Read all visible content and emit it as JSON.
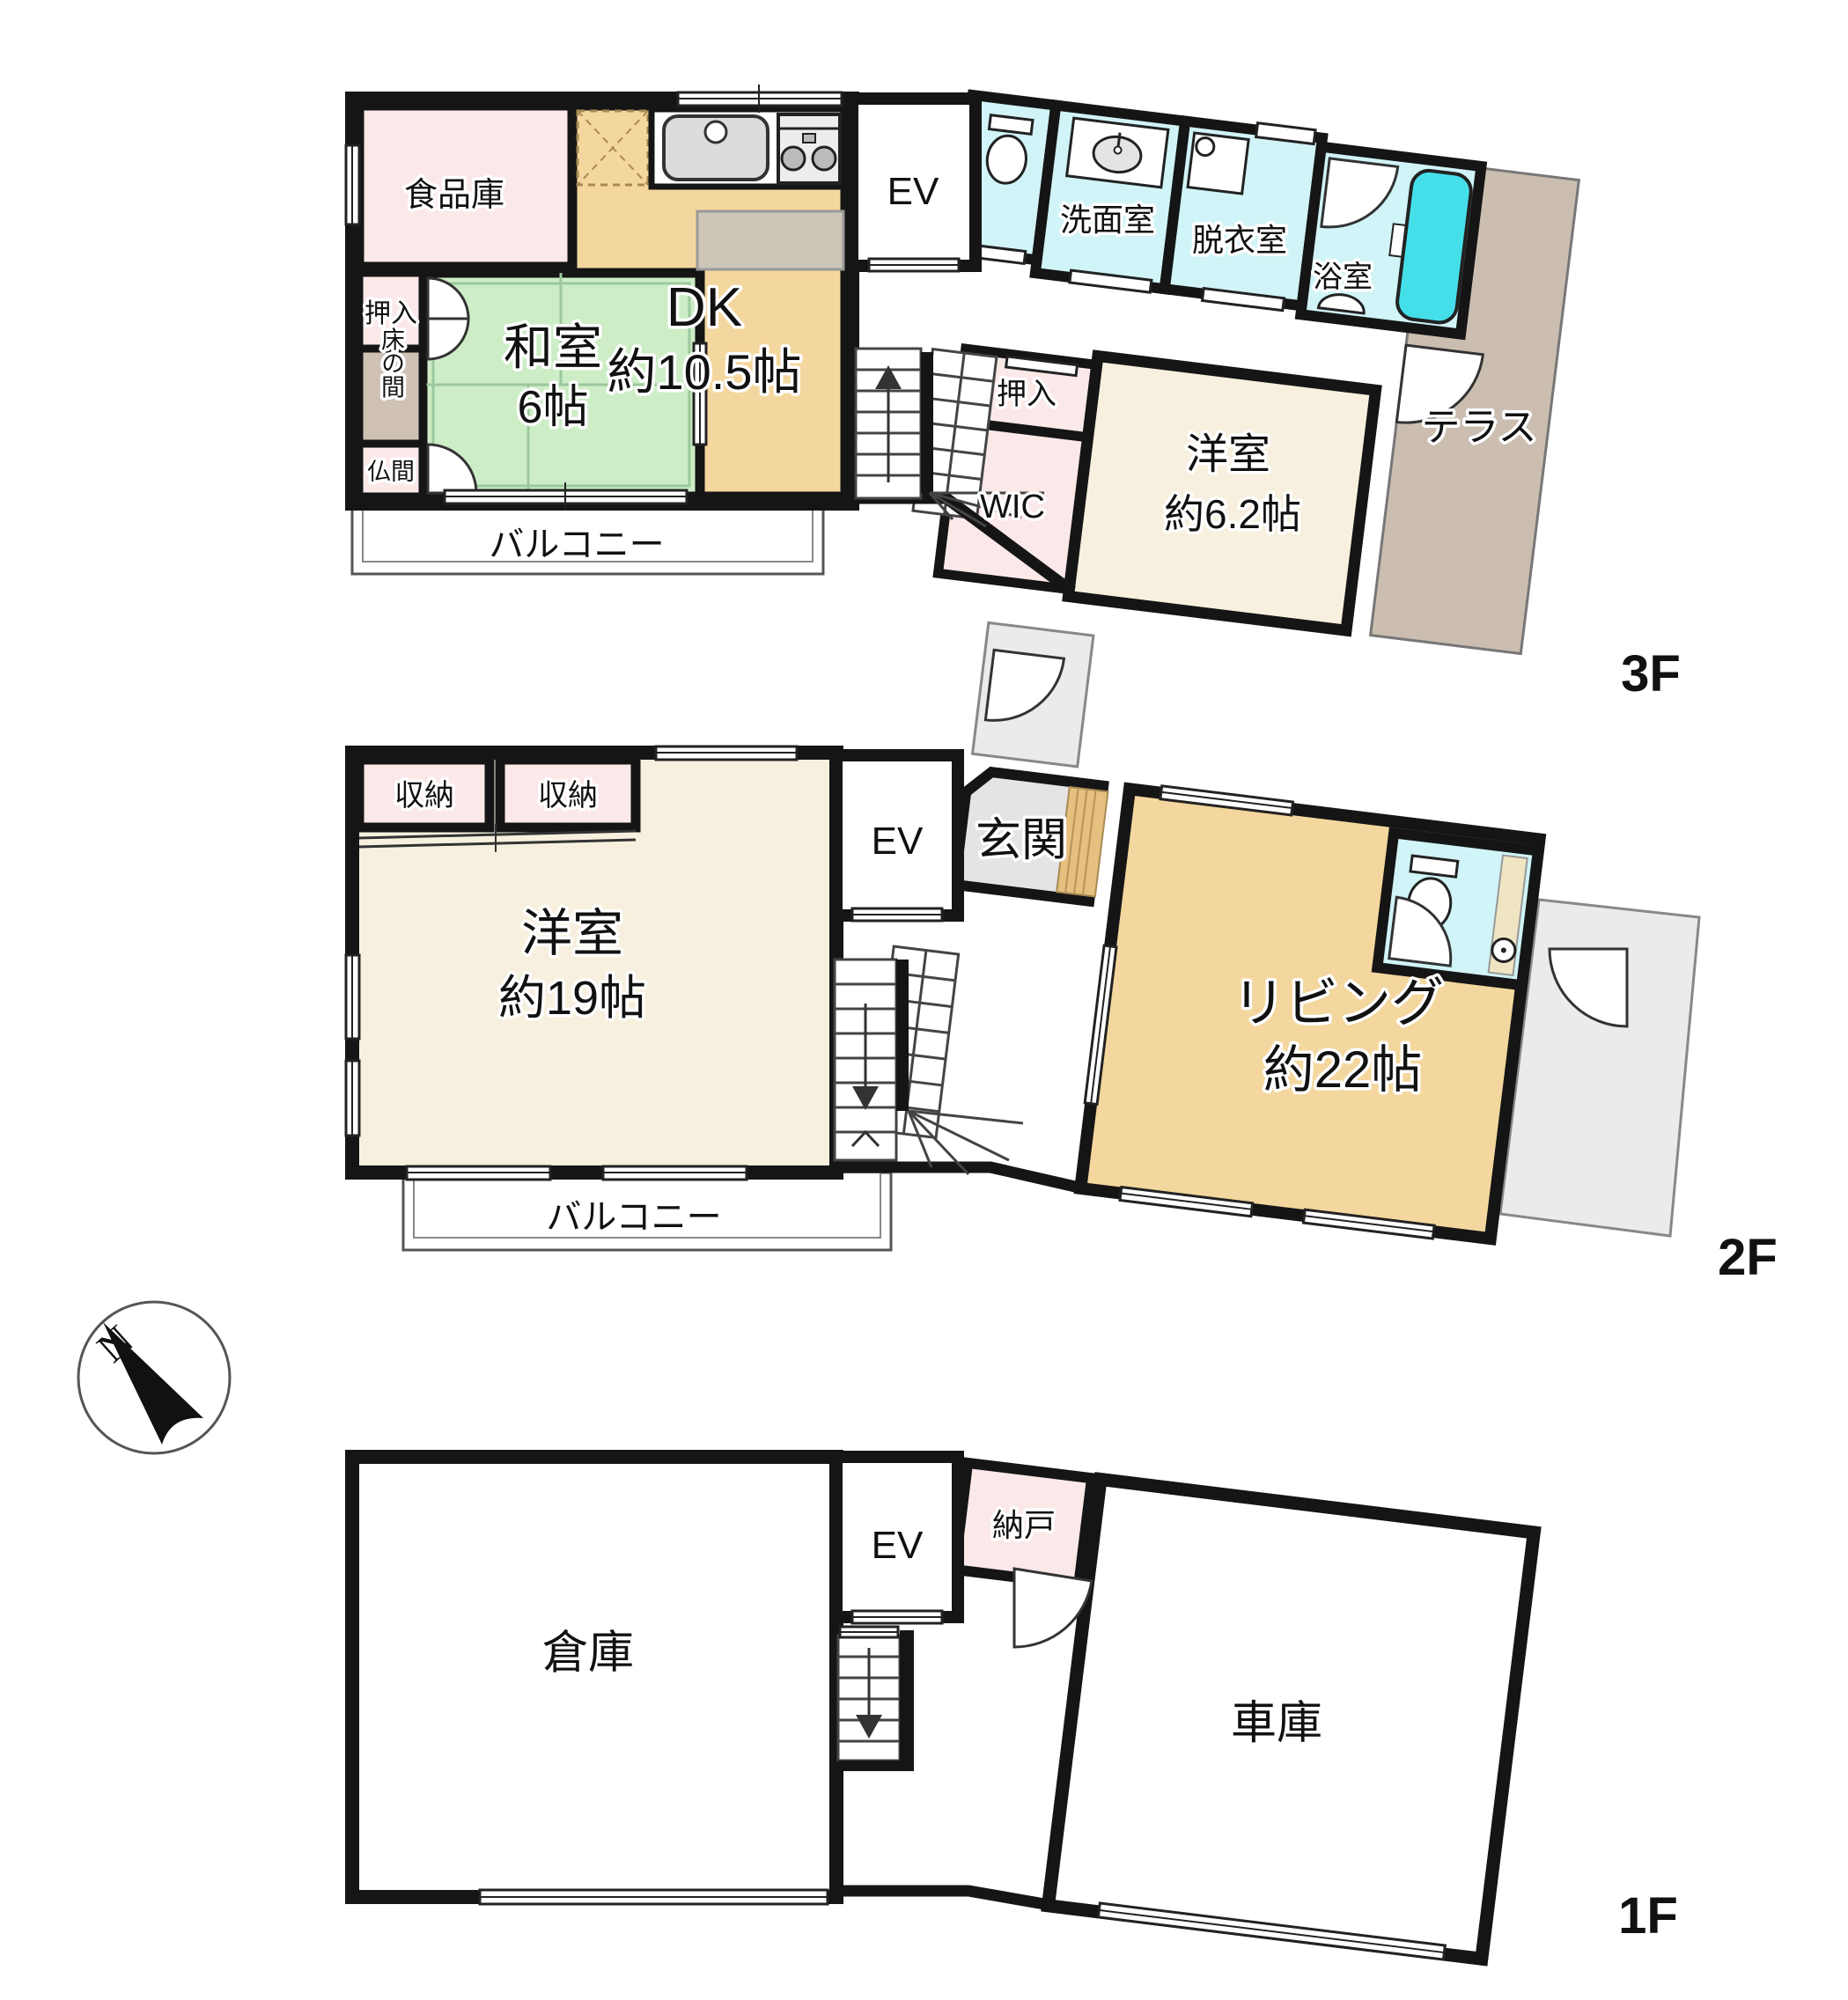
{
  "title": "3-story house floor plan",
  "f3": {
    "floor": "3F",
    "pantry": "食品庫",
    "dk": "DK",
    "dk_size": "約10.5帖",
    "washitsu": "和室",
    "washitsu_size": "6帖",
    "oshiire": "押入",
    "tokonoma": "床の間",
    "butsuma": "仏間",
    "balcony": "バルコニー",
    "ev": "EV",
    "senmen": "洗面室",
    "datsui": "脱衣室",
    "bath": "浴室",
    "oshiire2": "押入",
    "wic": "WIC",
    "youshitsu": "洋室",
    "youshitsu_size": "約6.2帖",
    "terrace": "テラス"
  },
  "f2": {
    "floor": "2F",
    "storage1": "収納",
    "storage2": "収納",
    "youshitsu": "洋室",
    "youshitsu_size": "約19帖",
    "ev": "EV",
    "genkan": "玄関",
    "living": "リビング",
    "living_size": "約22帖",
    "balcony": "バルコニー"
  },
  "f1": {
    "floor": "1F",
    "warehouse": "倉庫",
    "ev": "EV",
    "nando": "納戸",
    "garage": "車庫"
  },
  "compass": {
    "north": "N"
  },
  "colors": {
    "wall": "#151515",
    "tatami_green": "#CDEDC7",
    "wood_tan": "#F4D79E",
    "cream": "#F7F0DE",
    "pink": "#FBE8E8",
    "bath_cyan": "#D0F4F7",
    "tub_cyan": "#45DFEA",
    "terrace_brown": "#CBBEB1",
    "tokonoma_taupe": "#CFC2B4",
    "outdoor_gray": "#EBEBEB",
    "genkan_step_wood": "#E5C07E"
  }
}
